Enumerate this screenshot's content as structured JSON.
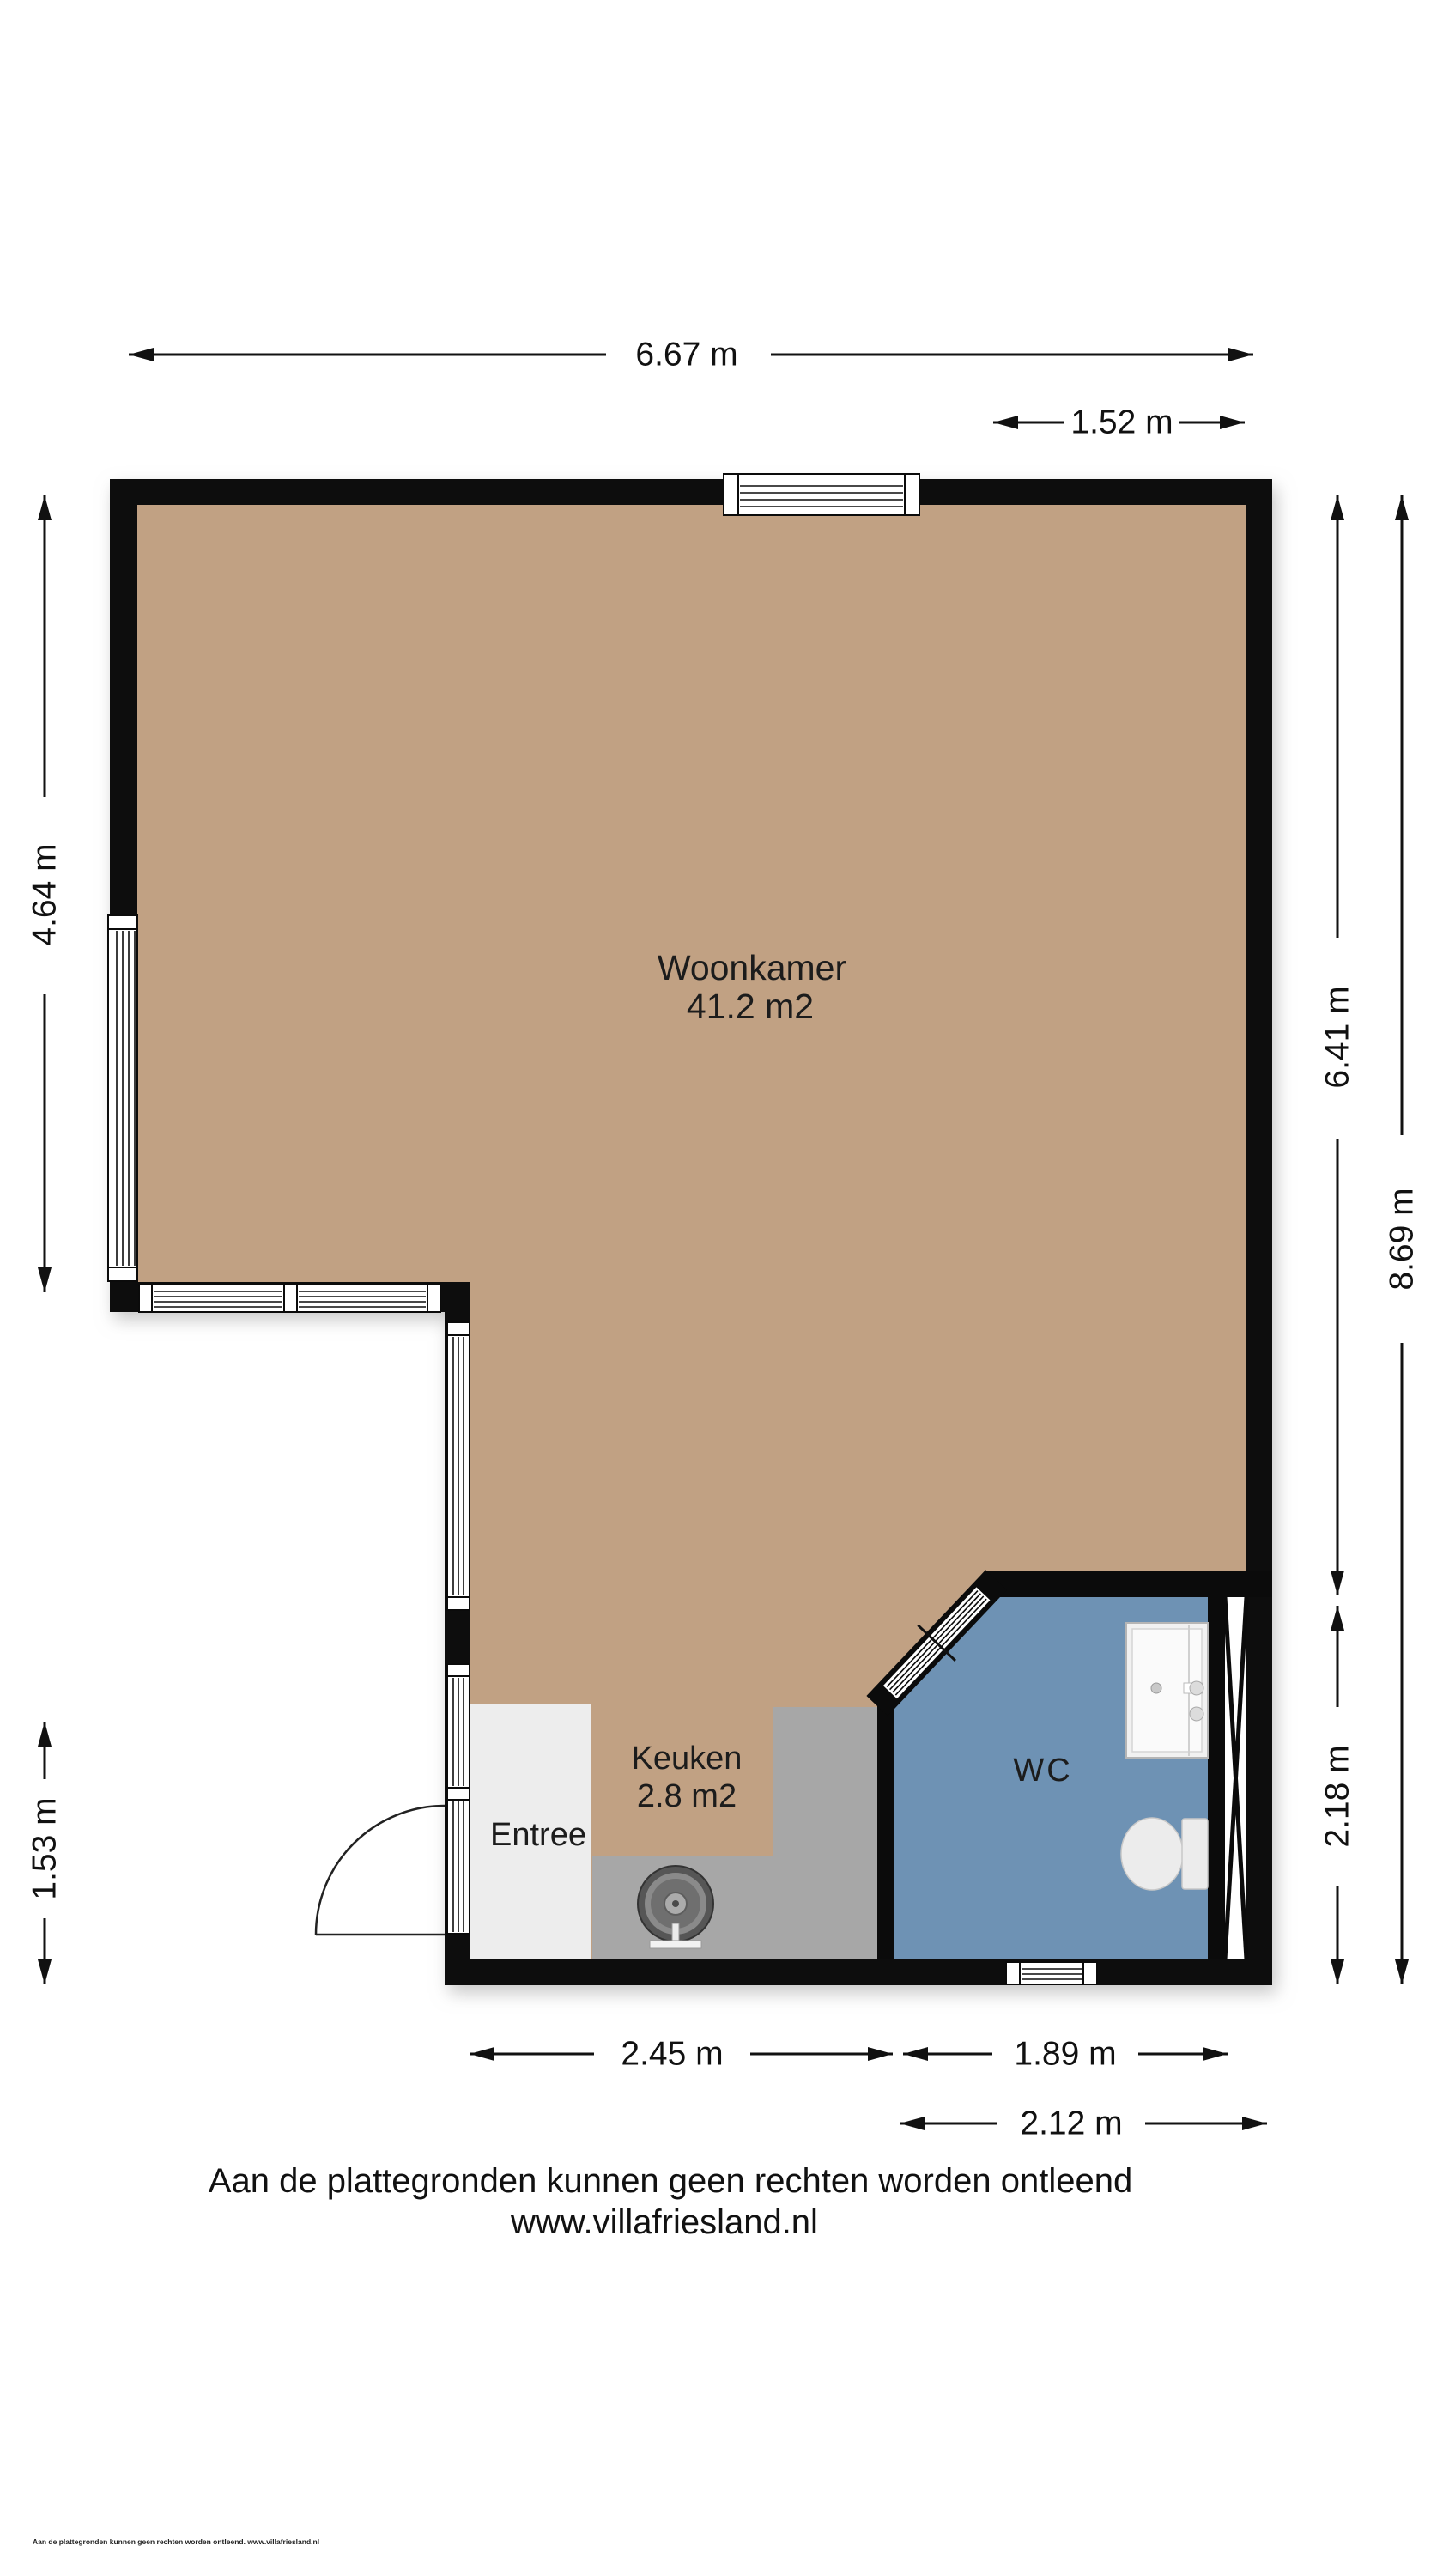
{
  "title": "Plattegrond begane grond",
  "rooms": {
    "woonkamer": {
      "name": "Woonkamer",
      "area": "41.2 m2"
    },
    "keuken": {
      "name": "Keuken",
      "area": "2.8 m2"
    },
    "entree": {
      "name": "Entree"
    },
    "wc": {
      "name": "WC"
    }
  },
  "dimensions": {
    "top_total": "6.67 m",
    "top_right": "1.52 m",
    "left_upper": "4.64 m",
    "left_lower": "1.53 m",
    "right_inner": "6.41 m",
    "right_total": "8.69 m",
    "right_lower": "2.18 m",
    "bottom_left": "2.45 m",
    "bottom_middle": "1.89 m",
    "bottom_right": "2.12 m"
  },
  "footer": {
    "disclaimer": "Aan de plattegronden kunnen geen rechten worden ontleend",
    "website": "www.villafriesland.nl",
    "fine_print": "Aan de plattegronden kunnen geen rechten worden ontleend. www.villafriesland.nl"
  },
  "colors": {
    "floor_tan": "#c1a183",
    "wc_blue": "#6e92b4",
    "entree_gray": "#ededed",
    "counter_gray": "#a7a7a7",
    "wall_black": "#0b0b0b"
  }
}
